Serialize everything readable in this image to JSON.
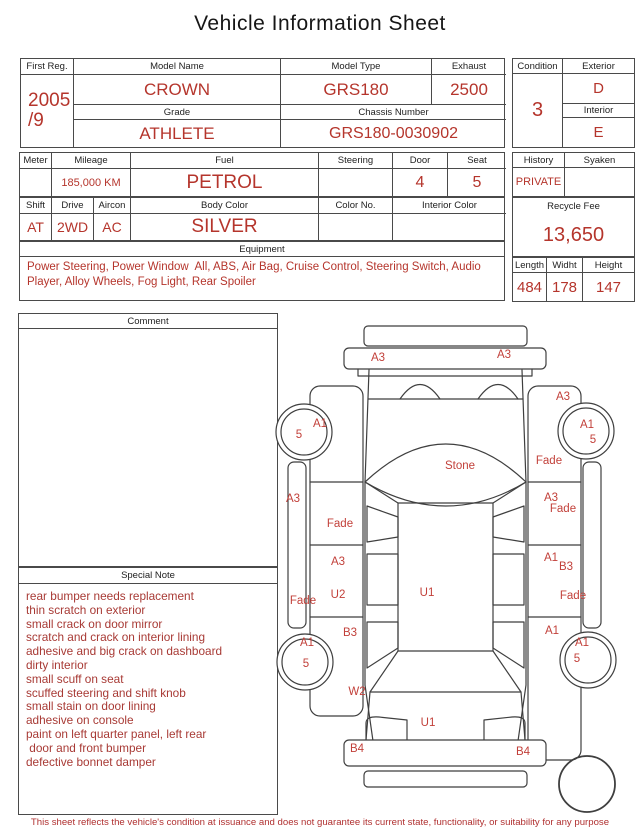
{
  "title": "Vehicle Information Sheet",
  "table1": {
    "first_reg": {
      "label": "First Reg.",
      "line1": "2005",
      "line2": "/9"
    },
    "model_name": {
      "label": "Model Name",
      "value": "CROWN"
    },
    "model_type": {
      "label": "Model Type",
      "value": "GRS180"
    },
    "exhaust": {
      "label": "Exhaust",
      "value": "2500"
    },
    "grade": {
      "label": "Grade",
      "value": "ATHLETE"
    },
    "chassis": {
      "label": "Chassis Number",
      "value": "GRS180-0030902"
    }
  },
  "condition_box": {
    "condition": {
      "label": "Condition",
      "value": "3"
    },
    "exterior": {
      "label": "Exterior",
      "value": "D"
    },
    "interior": {
      "label": "Interior",
      "value": "E"
    }
  },
  "table2": {
    "meter": {
      "label": "Meter",
      "value": ""
    },
    "mileage": {
      "label": "Mileage",
      "value": "185,000 KM"
    },
    "fuel": {
      "label": "Fuel",
      "value": "PETROL"
    },
    "steering": {
      "label": "Steering",
      "value": ""
    },
    "door": {
      "label": "Door",
      "value": "4"
    },
    "seat": {
      "label": "Seat",
      "value": "5"
    }
  },
  "history_box": {
    "history": {
      "label": "History",
      "value": "PRIVATE"
    },
    "syaken": {
      "label": "Syaken",
      "value": ""
    }
  },
  "table3": {
    "shift": {
      "label": "Shift",
      "value": "AT"
    },
    "drive": {
      "label": "Drive",
      "value": "2WD"
    },
    "aircon": {
      "label": "Aircon",
      "value": "AC"
    },
    "body_color": {
      "label": "Body Color",
      "value": "SILVER"
    },
    "color_no": {
      "label": "Color No.",
      "value": ""
    },
    "interior_color": {
      "label": "Interior Color",
      "value": ""
    }
  },
  "recycle_box": {
    "label": "Recycle Fee",
    "value": "13,650"
  },
  "dimensions": {
    "length": {
      "label": "Length",
      "value": "484"
    },
    "width": {
      "label": "Widht",
      "value": "178"
    },
    "height": {
      "label": "Height",
      "value": "147"
    }
  },
  "equipment": {
    "label": "Equipment",
    "value": "Power Steering, Power Window  All, ABS, Air Bag, Cruise Control, Steering Switch, Audio Player, Alloy Wheels, Fog Light, Rear Spoiler"
  },
  "comment": {
    "label": "Comment",
    "value": ""
  },
  "special_note": {
    "label": "Special Note",
    "lines": [
      "rear bumper needs replacement",
      "thin scratch on exterior",
      "small crack on door mirror",
      "scratch and crack on interior lining",
      "adhesive and big crack on dashboard",
      "dirty interior",
      "small scuff on seat",
      "scuffed steering and shift knob",
      "small stain on door lining",
      "adhesive on console",
      "paint on left quarter panel, left rear",
      " door and front bumper",
      "defective bonnet damper"
    ]
  },
  "diagram": {
    "labels": [
      {
        "text": "A3",
        "x": 108,
        "y": 51
      },
      {
        "text": "A3",
        "x": 234,
        "y": 48
      },
      {
        "text": "Stone",
        "x": 190,
        "y": 159
      },
      {
        "text": "A1",
        "x": 50,
        "y": 117
      },
      {
        "text": "5",
        "x": 29,
        "y": 128
      },
      {
        "text": "A3",
        "x": 293,
        "y": 90
      },
      {
        "text": "A1",
        "x": 317,
        "y": 118
      },
      {
        "text": "5",
        "x": 323,
        "y": 133
      },
      {
        "text": "Fade",
        "x": 279,
        "y": 154
      },
      {
        "text": "A3",
        "x": 23,
        "y": 192
      },
      {
        "text": "Fade",
        "x": 70,
        "y": 217
      },
      {
        "text": "A3",
        "x": 281,
        "y": 191
      },
      {
        "text": "Fade",
        "x": 293,
        "y": 202
      },
      {
        "text": "A3",
        "x": 68,
        "y": 255
      },
      {
        "text": "U2",
        "x": 68,
        "y": 288
      },
      {
        "text": "U1",
        "x": 157,
        "y": 286
      },
      {
        "text": "A1",
        "x": 281,
        "y": 251
      },
      {
        "text": "B3",
        "x": 296,
        "y": 260
      },
      {
        "text": "Fade",
        "x": 33,
        "y": 294
      },
      {
        "text": "Fade",
        "x": 303,
        "y": 289
      },
      {
        "text": "B3",
        "x": 80,
        "y": 326
      },
      {
        "text": "A1",
        "x": 282,
        "y": 324
      },
      {
        "text": "A1",
        "x": 37,
        "y": 336
      },
      {
        "text": "5",
        "x": 36,
        "y": 357
      },
      {
        "text": "A1",
        "x": 312,
        "y": 336
      },
      {
        "text": "5",
        "x": 307,
        "y": 352
      },
      {
        "text": "W2",
        "x": 87,
        "y": 385
      },
      {
        "text": "U1",
        "x": 158,
        "y": 416
      },
      {
        "text": "B4",
        "x": 87,
        "y": 442
      },
      {
        "text": "B4",
        "x": 253,
        "y": 445
      }
    ]
  },
  "footer": "This sheet reflects the vehicle's condition at issuance and does not guarantee its current state, functionality, or suitability for any purpose",
  "colors": {
    "value_red": "#b5352c",
    "note_red": "#a83a35",
    "diagram_red": "#c2403a",
    "border_gray": "#4a4a4a",
    "background": "#ffffff"
  }
}
